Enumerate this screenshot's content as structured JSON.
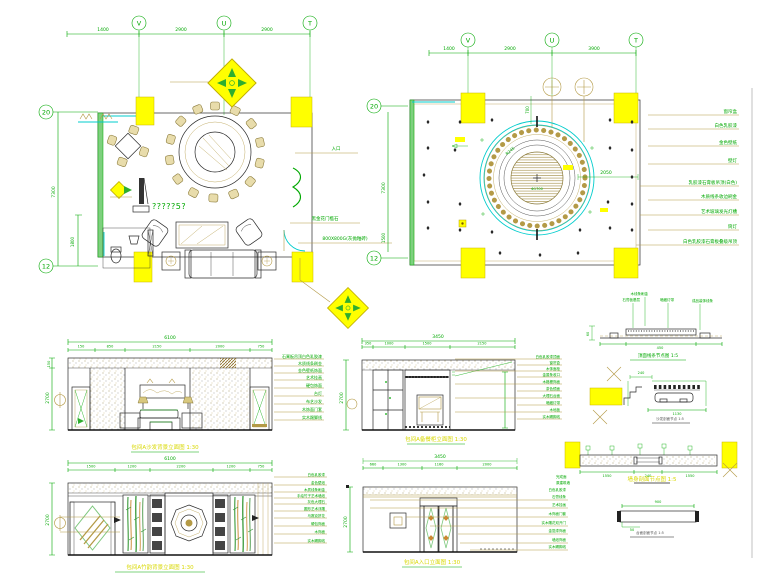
{
  "colors": {
    "line_green": "#00a800",
    "cad_yellow": "#ffff00",
    "tan": "#b49a46",
    "cyan": "#00cccc",
    "title_yellow": "#d8d800"
  },
  "floor_plan": {
    "grid": {
      "v": "V",
      "u": "U",
      "t": "T"
    },
    "dims": {
      "d1": "1400",
      "d2": "2900",
      "d3": "2900",
      "left_main": "7300",
      "left_sub": "1800"
    },
    "bubbles": {
      "top": "20",
      "bottom": "12"
    },
    "room_label": "?????5?",
    "notes": {
      "entry": "入口",
      "threshold": "黑金花门槛石",
      "floor": "800X800G(灰抛釉砖)"
    }
  },
  "ceiling_plan": {
    "grid": {
      "v": "V",
      "u": "U",
      "t": "T"
    },
    "dims": {
      "d1": "1400",
      "d2": "2900",
      "d3": "3900",
      "left_main": "7300",
      "left_sub": "1500",
      "h700": "700",
      "w2050": "2050",
      "r245": "R245"
    },
    "bubbles": {
      "top": "20",
      "bottom": "12"
    },
    "center_label": "Φ1700",
    "annotations": [
      "窗帘盒",
      "白色乳胶漆",
      "金色壁纸",
      "壁灯",
      "乳胶漆石膏板吊顶(白色)",
      "木质线条收边刷金",
      "艺术玻璃发光灯槽",
      "筒灯",
      "白色乳胶漆石膏板叠级吊顶"
    ]
  },
  "elevations": {
    "a": {
      "title": "包间A沙发背景立面图 1:30",
      "overall": "6100",
      "height": "2700",
      "sub": "150",
      "segs": [
        "150",
        "850",
        "2150",
        "2000",
        "750"
      ],
      "notes": [
        "石膏板吊顶白色乳胶漆",
        "木质线条刷金",
        "金色壁纸饰面",
        "艺术挂画",
        "硬包饰面",
        "台灯",
        "布艺沙发",
        "木饰面门套",
        "实木踢脚线"
      ]
    },
    "b": {
      "title": "包间A备餐柜立面图 1:30",
      "overall": "3450",
      "height": "2700",
      "segs": [
        "350",
        "1000",
        "1500",
        "2150"
      ],
      "notes": [
        "白色乳胶漆顶面",
        "窗帘盒",
        "木饰面柜",
        "金属条收口",
        "木格栅饰面",
        "茶色镜面",
        "大理石台面",
        "暗藏灯带",
        "木地板",
        "实木踢脚线"
      ]
    },
    "c": {
      "title": "包间A竹韵背景立面图 1:30",
      "overall": "6100",
      "height": "2700",
      "segs": [
        "1500",
        "1200",
        "2200",
        "1200",
        "750"
      ],
      "notes": [
        "白色乳胶漆",
        "金色壁纸",
        "木质线条刷金",
        "手绘竹子艺术墙纸",
        "灰色大理石",
        "圆形艺术浮雕",
        "马赛克拼花",
        "硬包饰面",
        "木饰面",
        "实木踢脚线"
      ]
    },
    "d": {
      "title": "包间A入口立面图 1:30",
      "overall": "3450",
      "height": "2700",
      "segs": [
        "660",
        "1300",
        "1160",
        "2000"
      ],
      "notes": [
        "白色乳胶漆",
        "石膏线条",
        "艺术挂画",
        "木饰面门套",
        "实木雕花双开门",
        "金箔漆饰面",
        "墙纸饰面",
        "实木踢脚线"
      ]
    }
  },
  "details": {
    "d1": {
      "title": "顶面线条节点图 1:5",
      "notes": [
        "木线条刷金",
        "石膏板基层",
        "暗藏灯带",
        "成品装饰线条"
      ],
      "dims": [
        "60",
        "450"
      ]
    },
    "d2": {
      "title": "沙发剖面节点 1:5",
      "dims": [
        "240",
        "1130"
      ]
    },
    "d3": {
      "title": "墙身剖面节点图 1:5",
      "notes": [
        "完成面",
        "原建筑墙"
      ],
      "dims": [
        "1550",
        "240",
        "1550"
      ]
    },
    "d4": {
      "title": "台面剖面节点 1:5",
      "dims": [
        "900",
        "50"
      ]
    }
  }
}
